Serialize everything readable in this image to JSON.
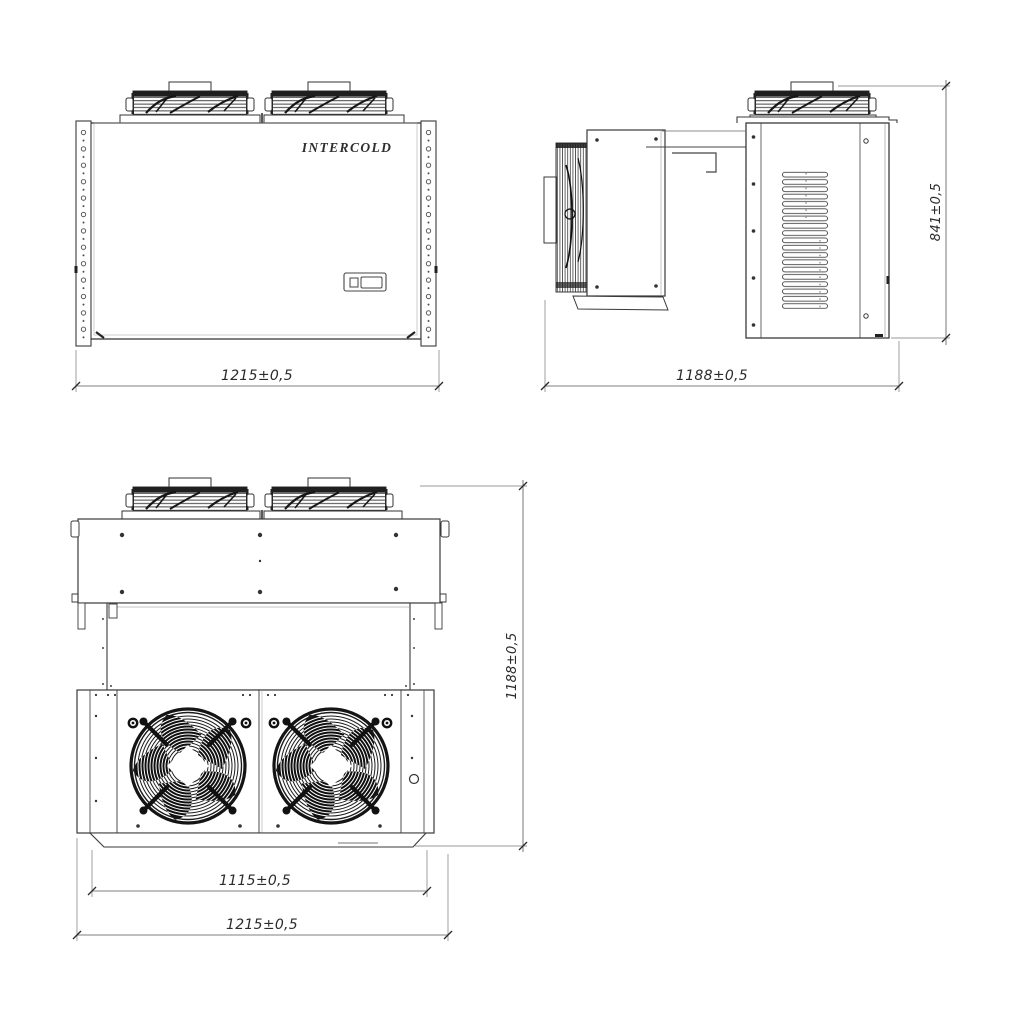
{
  "page": {
    "background": "#ffffff",
    "line_color": "#3a3a3a",
    "dark_detail_color": "#161616"
  },
  "brand": {
    "label": "INTERCOLD"
  },
  "views": {
    "front": {
      "label": "front view",
      "dim_width": "1215±0,5"
    },
    "side": {
      "label": "side view",
      "dim_depth": "1188±0,5",
      "dim_height": "841±0,5"
    },
    "plan": {
      "label": "bottom view",
      "dim_fan_section": "1115±0,5",
      "dim_width": "1215±0,5",
      "dim_depth": "1188±0,5"
    }
  }
}
